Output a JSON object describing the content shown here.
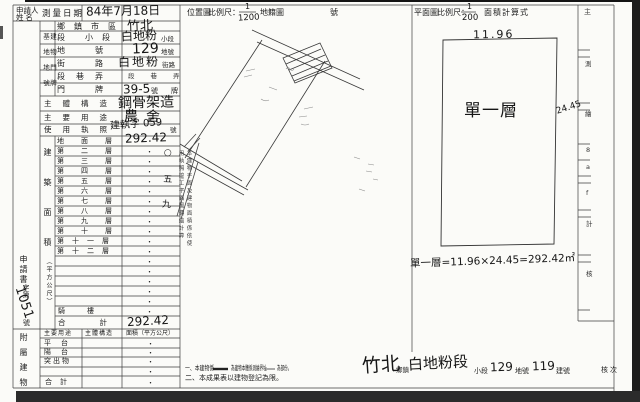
{
  "header": {
    "applicant_line1": "申請人",
    "applicant_line2": "姓  名",
    "survey_date_label": "測量日期",
    "survey_date_value": "84年7月18日",
    "location_map_label": "位置圖",
    "scale1_label": "比例尺：",
    "scale1_num": "1",
    "scale1_den": "1200",
    "cadastre_label": "地籍圖",
    "sheet_no_label": "號",
    "plan_label": "平面圖",
    "scale2_label": "比例尺：",
    "scale2_num": "1",
    "scale2_den": "200",
    "area_calc_label": "面積計算式"
  },
  "site": {
    "group_col_left": "基地地號",
    "group_col_right": "建物門牌",
    "r1_label": "鄉鎮市區",
    "r1_value": "竹北",
    "r2_label": "段 小段",
    "r2_value": "白地粉",
    "r2_suffix": "小段",
    "r3_label": "地號",
    "r3_value": "129",
    "r3_suffix": "地號",
    "r4_label": "街路",
    "r4_value": "白地粉",
    "r4_suffix": "街路",
    "r5_label": "段巷弄",
    "r5_value": "段巷弄",
    "r6_label": "門牌",
    "r6_value": "39-5",
    "r6_suffix": "號",
    "r6_suffix2": "牌",
    "structure_label": "主體構造",
    "structure_value": "鋼骨架造",
    "use_label": "主要用途",
    "use_value": "農舍",
    "license_label": "使用執照",
    "license_value": "建執字 059",
    "license_suffix": "號"
  },
  "areas": {
    "column_label": "建築面積",
    "column_unit": "（平方公尺）",
    "ground_label": "地面層",
    "ground_value": "292.42",
    "floor_labels": [
      "第二層",
      "第三層",
      "第四層",
      "第五層",
      "第六層",
      "第七層",
      "第八層",
      "第九層",
      "第十層",
      "第十一層",
      "第十二層"
    ],
    "qilou_label": "騎樓",
    "total_label": "合計",
    "total_value": "292.42"
  },
  "application": {
    "label": "申請書",
    "zidi": "字第",
    "number": "1051",
    "hao": "號"
  },
  "annex": {
    "column_label": "附屬建物",
    "h1": "主要用途",
    "h2": "主體構造",
    "h3": "面積（平方公尺）",
    "r1": "平台",
    "r2": "陽台",
    "r3": "突出物",
    "total": "合計"
  },
  "misc": {
    "dot": "・",
    "hw_marks": "○五九"
  },
  "margin_note": {
    "col1": "本建物平面及建物面積係依使",
    "col2": "用執照竣工平面圖轉繪計算"
  },
  "plan": {
    "width_label": "11.96",
    "height_label": "24.45",
    "floor_label": "單一層",
    "formula": "單一層=11.96×24.45=292.42㎡"
  },
  "legend": {
    "l1a": "一、本建物係",
    "l1b": "為建物本體係測繪界址",
    "l1c": "為部份。",
    "l2": "二、本成果表以建物登記為限。"
  },
  "footer": {
    "township_value": "竹北",
    "township_label": "鄉鎮",
    "section_value": "白地粉段",
    "subsection_label": "小段",
    "lot_value": "129",
    "lot_label": "地號",
    "building_value": "119",
    "building_label": "建號",
    "review_label": "核次"
  },
  "strip": {
    "top_label": "主",
    "c1": "測",
    "c2": "繪",
    "c3": "計",
    "c4": "核",
    "m1": "8",
    "m2": "a",
    "m3": "f"
  }
}
